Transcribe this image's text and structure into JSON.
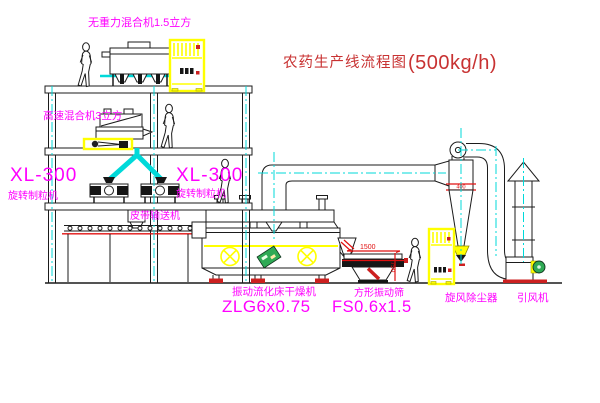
{
  "title": {
    "text_cn": "农药生产线流程图",
    "text_en": "(500kg/h)"
  },
  "labels": {
    "top_mixer": "无重力混合机1.5立方",
    "floor2_mixer": "高速混合机3立方",
    "granulator_left_model": "XL-300",
    "granulator_left_name": "旋转制粒机",
    "granulator_mid_model": "XL-300",
    "granulator_mid_name": "旋转制粒机",
    "belt_conveyor": "皮带输送机",
    "dryer_name": "振动流化床干燥机",
    "dryer_model": "ZLG6x0.75",
    "sieve_name": "方形振动筛",
    "sieve_model": "FS0.6x1.5",
    "cyclone_name": "旋风除尘器",
    "fan_name": "引风机"
  },
  "dimensions": {
    "sieve_length": "1500",
    "sieve_height": "750",
    "cyclone_mark": "400"
  },
  "colors": {
    "line": "#1b1b1b",
    "centerline_cyan": "#00d9d9",
    "label_magenta": "#ff00ff",
    "dimension_red": "#e01010",
    "title_red": "#c83232",
    "cabinet_yellow": "#ffff00",
    "accent_green": "#2faa55",
    "base_red": "#cc2020"
  }
}
